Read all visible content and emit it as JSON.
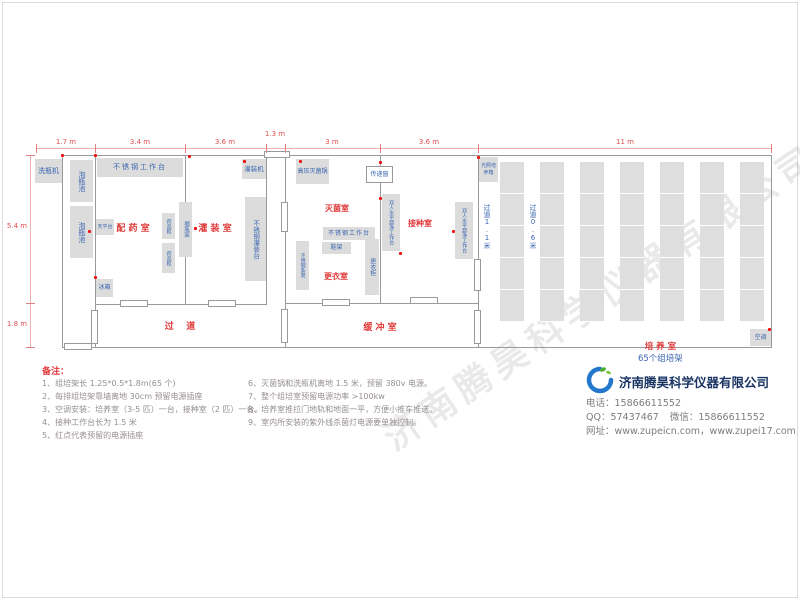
{
  "watermark": "济南腾昊科学仪器有限公司",
  "colors": {
    "accent_red": "#e03a3a",
    "label_blue": "#3a66b0",
    "dimension_red": "#e05050",
    "block_grey": "#dcdcdc",
    "wall_grey": "#9a9a9a",
    "outlet_dot_red": "#ee1111",
    "brand_navy": "#1a3563",
    "logo_blue": "#2577cc",
    "logo_green": "#4caf32"
  },
  "dims": {
    "top": [
      "1.7 m",
      "3.4 m",
      "3.6 m",
      "1.3 m",
      "3 m",
      "3.6 m",
      "11 m"
    ],
    "left": [
      "5.4 m",
      "1.8 m"
    ]
  },
  "rooms": {
    "prep": "配 药 室",
    "filling": "灌 装 室",
    "sterilization": "灭菌室",
    "changing": "更衣室",
    "inoculation": "接种室",
    "corridor": "过    道",
    "buffer": "缓 冲 室",
    "cultivation": "培 养 室",
    "cultivation_suffix": "65个组培架",
    "aisle_wide": "过道1.1米",
    "aisle_narrow": "过道0.6米"
  },
  "equipment": {
    "bottle_washer": "洗瓶机",
    "soak_pool": "泡瓶池",
    "ss_workbench": "不锈钢工作台",
    "balance_table": "天平台",
    "fridge": "冰箱",
    "medicine_cabinet": "药品柜",
    "bottle_rack": "搁瓶架",
    "filling_machine": "灌装机",
    "ss_filling_table": "不锈钢灌装台",
    "autoclave": "高压灭菌锅",
    "pass_window": "传递窗",
    "shoe_rack": "鞋架",
    "ss_bench": "不锈钢条凳",
    "locker": "更衣柜",
    "clean_bench": "双人水平超净工作台",
    "light_incubator": "光照培养箱",
    "air_conditioner": "空调"
  },
  "cultivation": {
    "rack_column_count": 7,
    "rack_width": 24,
    "rack_spacing": 40
  },
  "notes": {
    "title": "备注：",
    "col1": [
      "1、组培架长 1.25*0.5*1.8m(65 个)",
      "2、每排组培架靠墙离地 30cm 预留电源插座",
      "3、空调安装：培养室（3-5 匹）一台，接种室（2 匹）一台。",
      "4、接种工作台长为 1.5 米",
      "5、红点代表预留的电源插座"
    ],
    "col2": [
      "6、灭菌锅和洗瓶机离地 1.5 米，预留 380v 电源。",
      "7、整个组培室预留电源功率 >100kw",
      "8、培养室推拉门地轨和地面一平，方便小推车推送。",
      "9、室内所安装的紫外线杀菌灯电源要单独控制。"
    ]
  },
  "company": {
    "name": "济南腾昊科学仪器有限公司",
    "phone_label": "电话：",
    "phone": "15866611552",
    "qq_label": "QQ：",
    "qq": "57437467",
    "wechat_label": "微信：",
    "wechat": "15866611552",
    "web_label": "网址：",
    "web": "www.zupeicn.com，www.zupei17.com"
  }
}
